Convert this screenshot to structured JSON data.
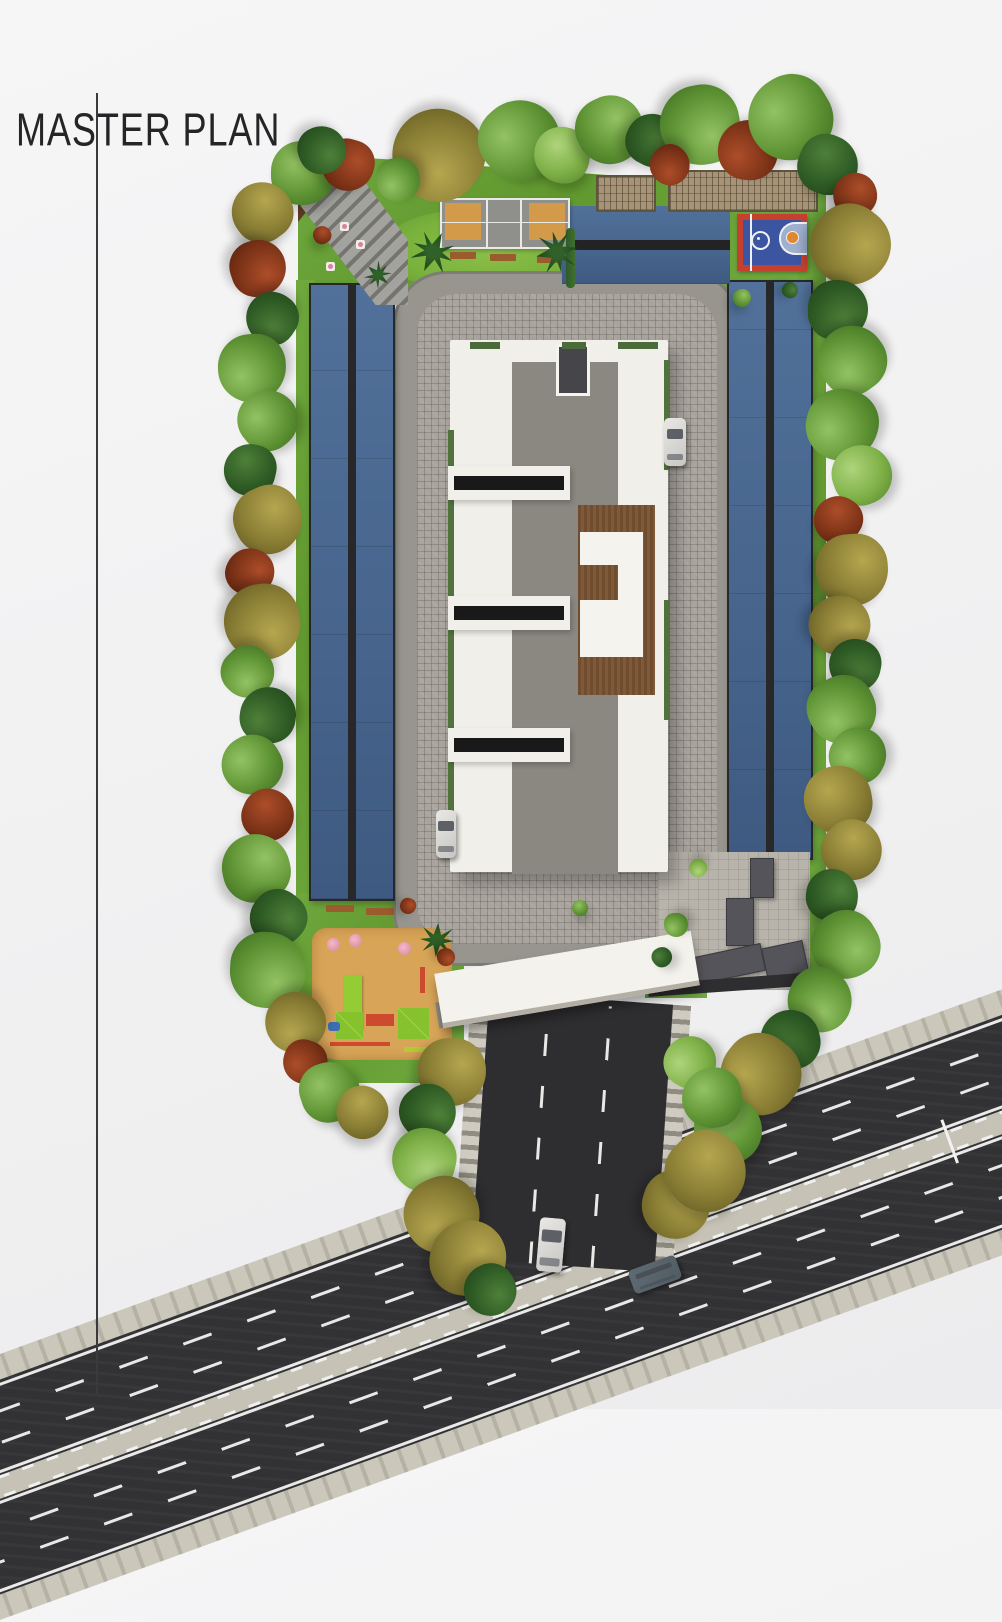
{
  "page": {
    "title": "MASTER PLAN"
  },
  "palette": {
    "background": "#f3f3f4",
    "title_text": "#252527",
    "lawn_green": "#61982f",
    "canopy_blue": "#47658d",
    "court_orange": "#d29a49",
    "basketball_red": "#c5402e",
    "basketball_blue": "#3b55a1",
    "building_white": "#f0efe9",
    "terrace_gray": "#8b8781",
    "deck_brown": "#7f5a38",
    "paver_gray": "#a9a49d",
    "asphalt": "#323235",
    "sidewalk": "#cbc7bb",
    "sand": "#d8a558",
    "play_equipment_green": "#93cc35"
  },
  "site": {
    "amenities": [
      {
        "name": "amphitheatre-steps"
      },
      {
        "name": "multipurpose-court"
      },
      {
        "name": "practice-net-pergola"
      },
      {
        "name": "basketball-half-court"
      },
      {
        "name": "covered-parking-left"
      },
      {
        "name": "covered-parking-right"
      },
      {
        "name": "central-apartment-building"
      },
      {
        "name": "kids-playground"
      },
      {
        "name": "utility-parking-pad"
      },
      {
        "name": "entrance-gate-canopy"
      },
      {
        "name": "entry-road"
      },
      {
        "name": "main-road"
      }
    ],
    "trees": [
      {
        "x": 303,
        "y": 173,
        "r": 32,
        "t": "g"
      },
      {
        "x": 262,
        "y": 212,
        "r": 30,
        "t": "og"
      },
      {
        "x": 348,
        "y": 165,
        "r": 26,
        "t": "rd"
      },
      {
        "x": 322,
        "y": 150,
        "r": 24,
        "t": "dg"
      },
      {
        "x": 438,
        "y": 155,
        "r": 46,
        "t": "og"
      },
      {
        "x": 398,
        "y": 180,
        "r": 22,
        "t": "g"
      },
      {
        "x": 520,
        "y": 140,
        "r": 40,
        "t": "g"
      },
      {
        "x": 562,
        "y": 155,
        "r": 28,
        "t": "lg"
      },
      {
        "x": 610,
        "y": 130,
        "r": 34,
        "t": "g"
      },
      {
        "x": 652,
        "y": 140,
        "r": 26,
        "t": "dg"
      },
      {
        "x": 700,
        "y": 125,
        "r": 40,
        "t": "g"
      },
      {
        "x": 670,
        "y": 165,
        "r": 20,
        "t": "rd"
      },
      {
        "x": 748,
        "y": 150,
        "r": 30,
        "t": "rd"
      },
      {
        "x": 790,
        "y": 118,
        "r": 42,
        "t": "g"
      },
      {
        "x": 828,
        "y": 165,
        "r": 30,
        "t": "dg"
      },
      {
        "x": 855,
        "y": 195,
        "r": 22,
        "t": "rd"
      },
      {
        "x": 850,
        "y": 245,
        "r": 40,
        "t": "og"
      },
      {
        "x": 838,
        "y": 310,
        "r": 30,
        "t": "dg"
      },
      {
        "x": 852,
        "y": 360,
        "r": 34,
        "t": "g"
      },
      {
        "x": 842,
        "y": 425,
        "r": 36,
        "t": "g"
      },
      {
        "x": 862,
        "y": 475,
        "r": 30,
        "t": "lg"
      },
      {
        "x": 838,
        "y": 520,
        "r": 24,
        "t": "rd"
      },
      {
        "x": 852,
        "y": 570,
        "r": 36,
        "t": "og"
      },
      {
        "x": 840,
        "y": 625,
        "r": 30,
        "t": "og"
      },
      {
        "x": 855,
        "y": 665,
        "r": 26,
        "t": "dg"
      },
      {
        "x": 842,
        "y": 710,
        "r": 34,
        "t": "g"
      },
      {
        "x": 858,
        "y": 755,
        "r": 28,
        "t": "g"
      },
      {
        "x": 838,
        "y": 800,
        "r": 34,
        "t": "og"
      },
      {
        "x": 852,
        "y": 850,
        "r": 30,
        "t": "og"
      },
      {
        "x": 832,
        "y": 895,
        "r": 26,
        "t": "dg"
      },
      {
        "x": 845,
        "y": 945,
        "r": 34,
        "t": "g"
      },
      {
        "x": 820,
        "y": 1000,
        "r": 32,
        "t": "g"
      },
      {
        "x": 790,
        "y": 1040,
        "r": 30,
        "t": "dg"
      },
      {
        "x": 760,
        "y": 1075,
        "r": 40,
        "t": "og"
      },
      {
        "x": 728,
        "y": 1130,
        "r": 34,
        "t": "g"
      },
      {
        "x": 700,
        "y": 1170,
        "r": 30,
        "t": "dg"
      },
      {
        "x": 676,
        "y": 1205,
        "r": 34,
        "t": "og"
      },
      {
        "x": 258,
        "y": 268,
        "r": 28,
        "t": "rd"
      },
      {
        "x": 272,
        "y": 318,
        "r": 26,
        "t": "dg"
      },
      {
        "x": 252,
        "y": 368,
        "r": 34,
        "t": "g"
      },
      {
        "x": 268,
        "y": 420,
        "r": 30,
        "t": "g"
      },
      {
        "x": 250,
        "y": 470,
        "r": 26,
        "t": "dg"
      },
      {
        "x": 268,
        "y": 520,
        "r": 34,
        "t": "og"
      },
      {
        "x": 250,
        "y": 572,
        "r": 24,
        "t": "rd"
      },
      {
        "x": 262,
        "y": 622,
        "r": 38,
        "t": "og"
      },
      {
        "x": 248,
        "y": 672,
        "r": 26,
        "t": "g"
      },
      {
        "x": 268,
        "y": 715,
        "r": 28,
        "t": "dg"
      },
      {
        "x": 252,
        "y": 765,
        "r": 30,
        "t": "g"
      },
      {
        "x": 268,
        "y": 815,
        "r": 26,
        "t": "rd"
      },
      {
        "x": 256,
        "y": 868,
        "r": 34,
        "t": "g"
      },
      {
        "x": 278,
        "y": 918,
        "r": 28,
        "t": "dg"
      },
      {
        "x": 268,
        "y": 970,
        "r": 38,
        "t": "g"
      },
      {
        "x": 295,
        "y": 1022,
        "r": 30,
        "t": "og"
      },
      {
        "x": 305,
        "y": 1062,
        "r": 22,
        "t": "rd"
      },
      {
        "x": 330,
        "y": 1092,
        "r": 30,
        "t": "g"
      },
      {
        "x": 362,
        "y": 1112,
        "r": 26,
        "t": "og"
      },
      {
        "x": 452,
        "y": 1072,
        "r": 34,
        "t": "og"
      },
      {
        "x": 428,
        "y": 1112,
        "r": 28,
        "t": "dg"
      },
      {
        "x": 424,
        "y": 1160,
        "r": 32,
        "t": "lg"
      },
      {
        "x": 442,
        "y": 1215,
        "r": 38,
        "t": "og"
      },
      {
        "x": 690,
        "y": 1062,
        "r": 26,
        "t": "lg"
      },
      {
        "x": 712,
        "y": 1098,
        "r": 30,
        "t": "g"
      },
      {
        "x": 706,
        "y": 1172,
        "r": 40,
        "t": "og"
      },
      {
        "x": 468,
        "y": 1258,
        "r": 38,
        "t": "og"
      },
      {
        "x": 490,
        "y": 1290,
        "r": 26,
        "t": "dg"
      },
      {
        "x": 433,
        "y": 252,
        "r": 21,
        "t": "palm"
      },
      {
        "x": 557,
        "y": 252,
        "r": 21,
        "t": "palm"
      },
      {
        "x": 378,
        "y": 275,
        "r": 13,
        "t": "palm"
      },
      {
        "x": 437,
        "y": 940,
        "r": 17,
        "t": "palm"
      },
      {
        "x": 322,
        "y": 235,
        "r": 9,
        "t": "rd"
      },
      {
        "x": 408,
        "y": 906,
        "r": 8,
        "t": "rd"
      },
      {
        "x": 446,
        "y": 957,
        "r": 9,
        "t": "rd"
      },
      {
        "x": 698,
        "y": 868,
        "r": 9,
        "t": "lg"
      },
      {
        "x": 676,
        "y": 925,
        "r": 12,
        "t": "g"
      },
      {
        "x": 662,
        "y": 957,
        "r": 10,
        "t": "dg"
      },
      {
        "x": 580,
        "y": 908,
        "r": 8,
        "t": "g"
      },
      {
        "x": 742,
        "y": 298,
        "r": 9,
        "t": "g"
      },
      {
        "x": 790,
        "y": 290,
        "r": 8,
        "t": "dg"
      }
    ],
    "cars": [
      {
        "name": "parked-car-east",
        "x": 664,
        "y": 418,
        "w": 22,
        "h": 48,
        "rot": 0,
        "color": "#e9e8e4"
      },
      {
        "name": "parked-car-west",
        "x": 436,
        "y": 810,
        "w": 20,
        "h": 48,
        "rot": 0,
        "color": "#e9e8e4"
      },
      {
        "name": "car-entry-road",
        "x": 538,
        "y": 1218,
        "w": 26,
        "h": 54,
        "rot": 5,
        "color": "#e9e8e4"
      },
      {
        "name": "car-main-road",
        "x": 630,
        "y": 1262,
        "w": 50,
        "h": 25,
        "rot": -20,
        "color": "#5f6b74"
      }
    ]
  }
}
